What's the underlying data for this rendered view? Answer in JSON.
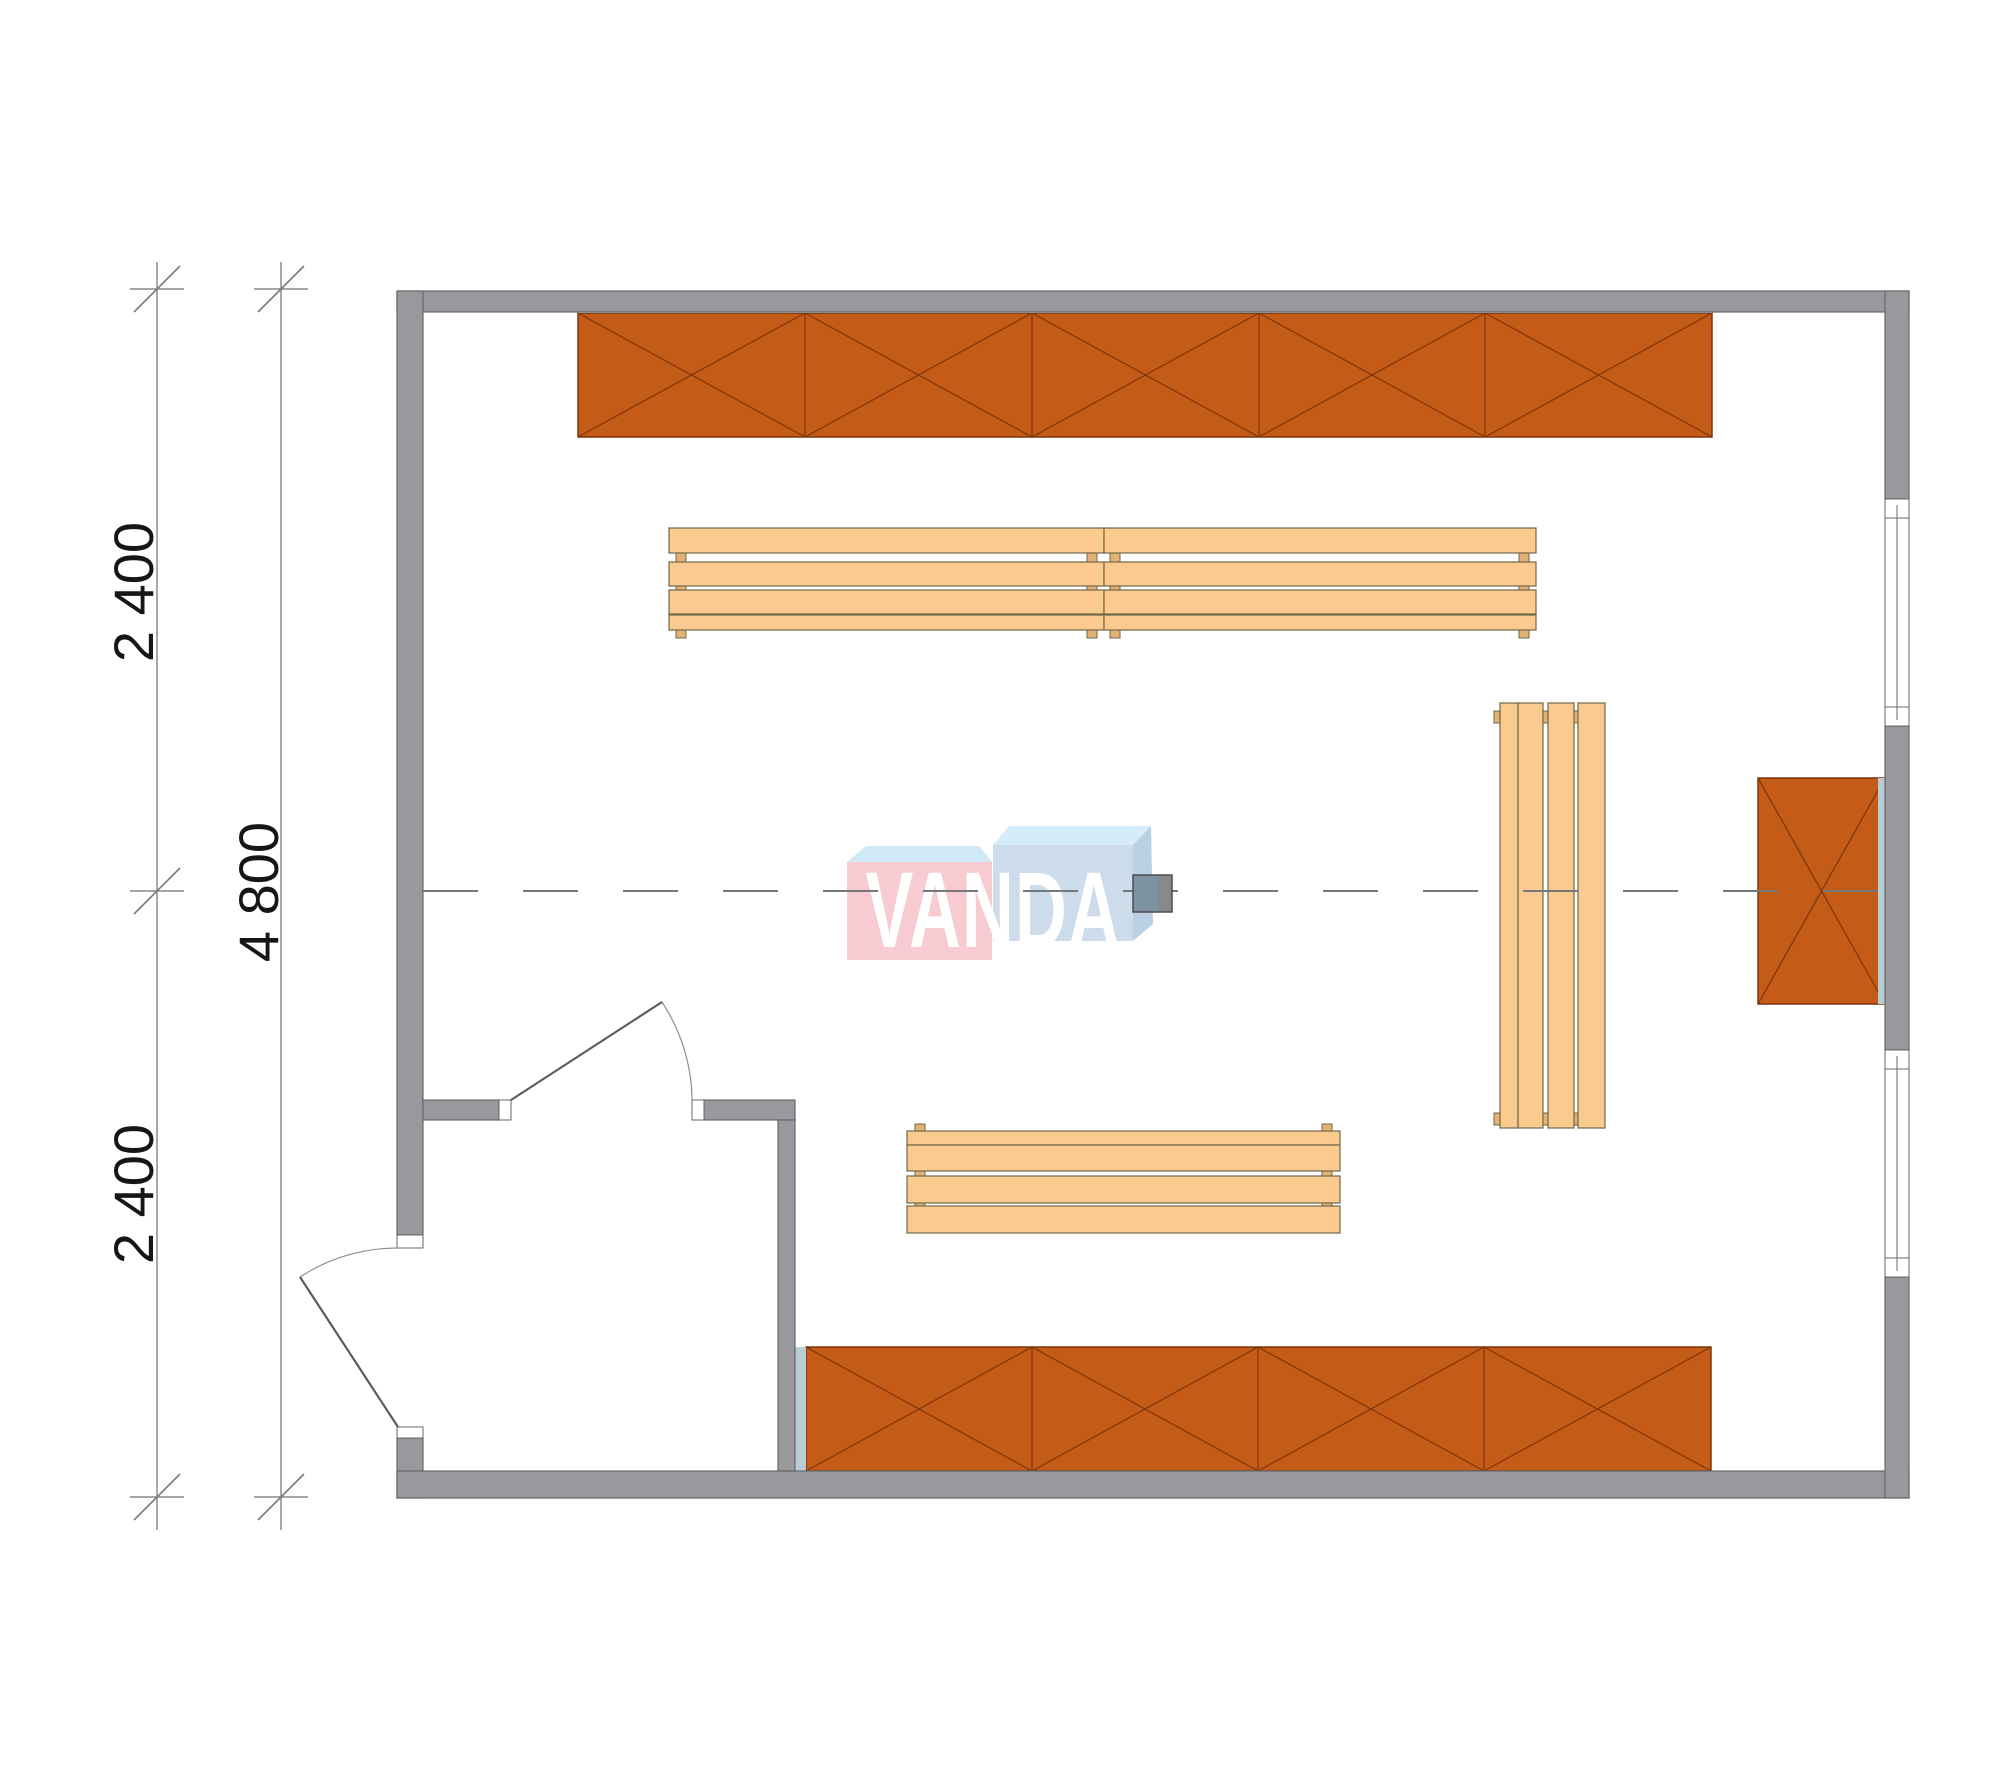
{
  "document": {
    "type": "architectural-floor-plan",
    "watermark": "VANDA"
  },
  "dimensions": {
    "overall_label": "4 800",
    "segment_labels": [
      "2 400",
      "2 400"
    ],
    "unit": "mm"
  },
  "colors": {
    "wall": "#97999c",
    "wall-border": "#66686a",
    "cabinet": "#c45b17",
    "cabinet-border": "#7d350b",
    "bench": "#fbca8e",
    "bench-border": "#6e6849",
    "bench-foot": "#e3b272",
    "accent-strip": "#b9cdd6",
    "centerline": "#76787a",
    "post-left": "#7e93a2",
    "post-right": "#87898b",
    "logo-pink": "#f8cad2",
    "logo-blue": "#cddcea",
    "logo-bevel-top": "#d5edfa",
    "logo-bevel-pink": "#cfe9f7",
    "logo-bevel-side": "#bad0e3"
  },
  "plan": {
    "rooms": [
      "main-room",
      "entry-vestibule"
    ],
    "cabinet_rows": [
      {
        "id": "top-wall-row",
        "sections": 5
      },
      {
        "id": "bottom-wall-row",
        "sections": 4
      },
      {
        "id": "right-wall-unit",
        "sections": 1
      }
    ],
    "benches": [
      "top-left",
      "top-right",
      "bottom",
      "right-vertical"
    ],
    "windows": 2,
    "doors": [
      "exterior-entry-door",
      "interior-vestibule-door"
    ]
  }
}
